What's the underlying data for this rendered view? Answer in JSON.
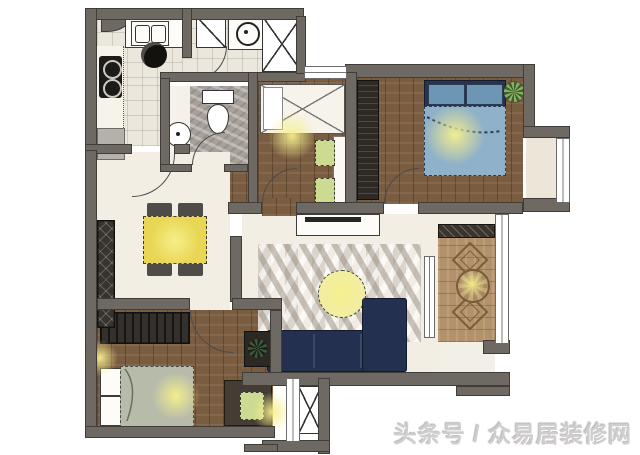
{
  "watermark": {
    "text": "头条号 / 众易居装修网"
  },
  "colors": {
    "wall": "#6e6962",
    "wall_line": "#403c37",
    "wood": "#7a5c41",
    "wood_light": "#b3916b",
    "tile": "#ebe7dc",
    "cream": "#f2eee4",
    "marble": "#a8a19a",
    "navy": "#233050",
    "bed_blue": "#8fb1c9",
    "pillow_blue": "#6d96b5",
    "sage": "#b7bbaa",
    "table_yellow": "#e8d654",
    "pale_yellow": "#f2eda6",
    "accent_green": "#cdda92",
    "dark_furn": "#332f2a",
    "glow": "#f4f0a0",
    "watermark": "#d0cdcd"
  },
  "legend": {
    "rooms": [
      "kitchen",
      "entry",
      "bathroom",
      "study",
      "master-bedroom",
      "dining",
      "living-room",
      "second-bedroom",
      "leisure-balcony",
      "service-balcony",
      "bay-window"
    ]
  }
}
